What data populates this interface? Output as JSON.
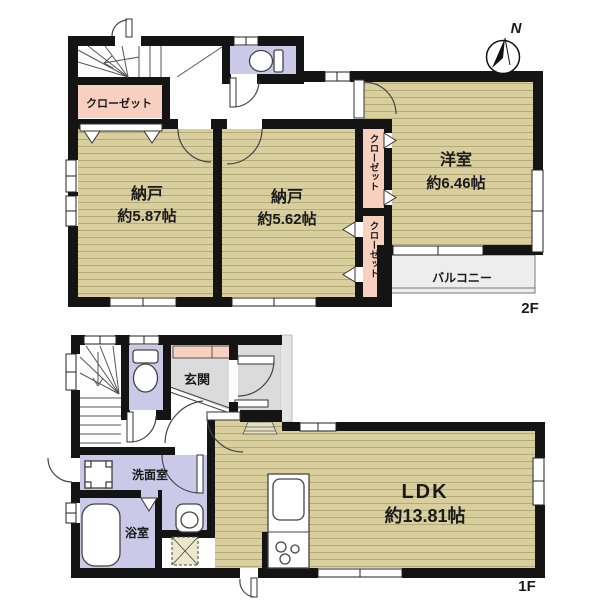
{
  "floor2": {
    "label": "2F",
    "closet_left": "クローゼット",
    "closet_upper": "クローゼット",
    "closet_lower": "クローゼット",
    "storage_a": {
      "name": "納戸",
      "area": "約5.87帖"
    },
    "storage_b": {
      "name": "納戸",
      "area": "約5.62帖"
    },
    "western": {
      "name": "洋室",
      "area": "約6.46帖"
    },
    "balcony": "バルコニー"
  },
  "floor1": {
    "label": "1F",
    "entrance": "玄関",
    "washroom": "洗面室",
    "bathroom": "浴室",
    "ldk": {
      "name": "LDK",
      "area": "約13.81帖"
    }
  },
  "compass": {
    "north": "N"
  },
  "colors": {
    "wall": "#141414",
    "tatami": "#D8CE9E",
    "tatami_line": "#B5AA7A",
    "closet_pink": "#F8D0BF",
    "wet_lavender": "#CACAE8",
    "entrance_gray": "#DBDBDB",
    "porch_gray": "#E4E4E4",
    "balcony_gray": "#EDEDED"
  }
}
